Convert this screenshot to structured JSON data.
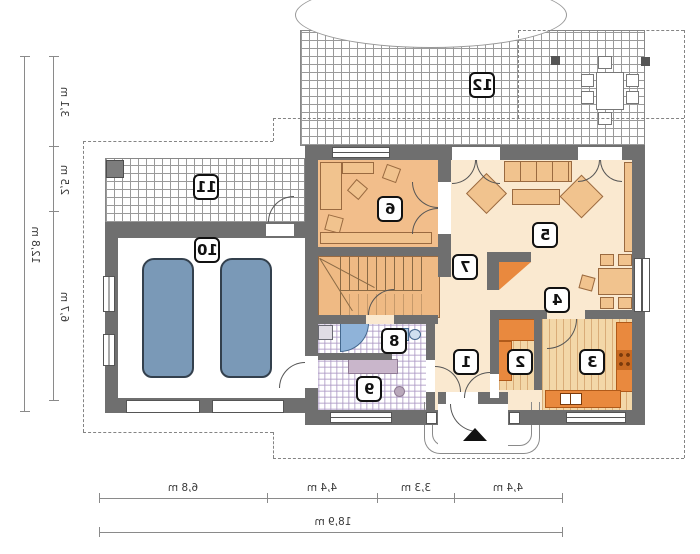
{
  "rooms": [
    {
      "label": "1"
    },
    {
      "label": "2"
    },
    {
      "label": "3"
    },
    {
      "label": "4"
    },
    {
      "label": "5"
    },
    {
      "label": "6"
    },
    {
      "label": "7"
    },
    {
      "label": "8"
    },
    {
      "label": "9"
    },
    {
      "label": "10"
    },
    {
      "label": "11"
    },
    {
      "label": "12"
    }
  ],
  "dimensions": {
    "left_total": "12,8 m",
    "left_segments": [
      "3,1 m",
      "2,5 m",
      "6,7 m"
    ],
    "bottom_segments": [
      "6,8 m",
      "4,4 m",
      "3,3 m",
      "4,4 m"
    ],
    "bottom_total": "18,9 m"
  },
  "colors": {
    "wall": "#6F6F6F",
    "floor_cream": "#FAE9D0",
    "floor_wood": "#F2BE8B",
    "floor_kitchen_stripe": "#F3D7A8",
    "counter_orange": "#E9893E",
    "bath_check": "#AA96C3",
    "fixture_blue": "#8FB3D9",
    "car_body": "#7A99B7",
    "car_glass": "#D9E4EE",
    "tile_line": "#9A9A9A"
  },
  "notes": {
    "text_style": "all labels mirrored (plan is horizontally flipped)"
  }
}
